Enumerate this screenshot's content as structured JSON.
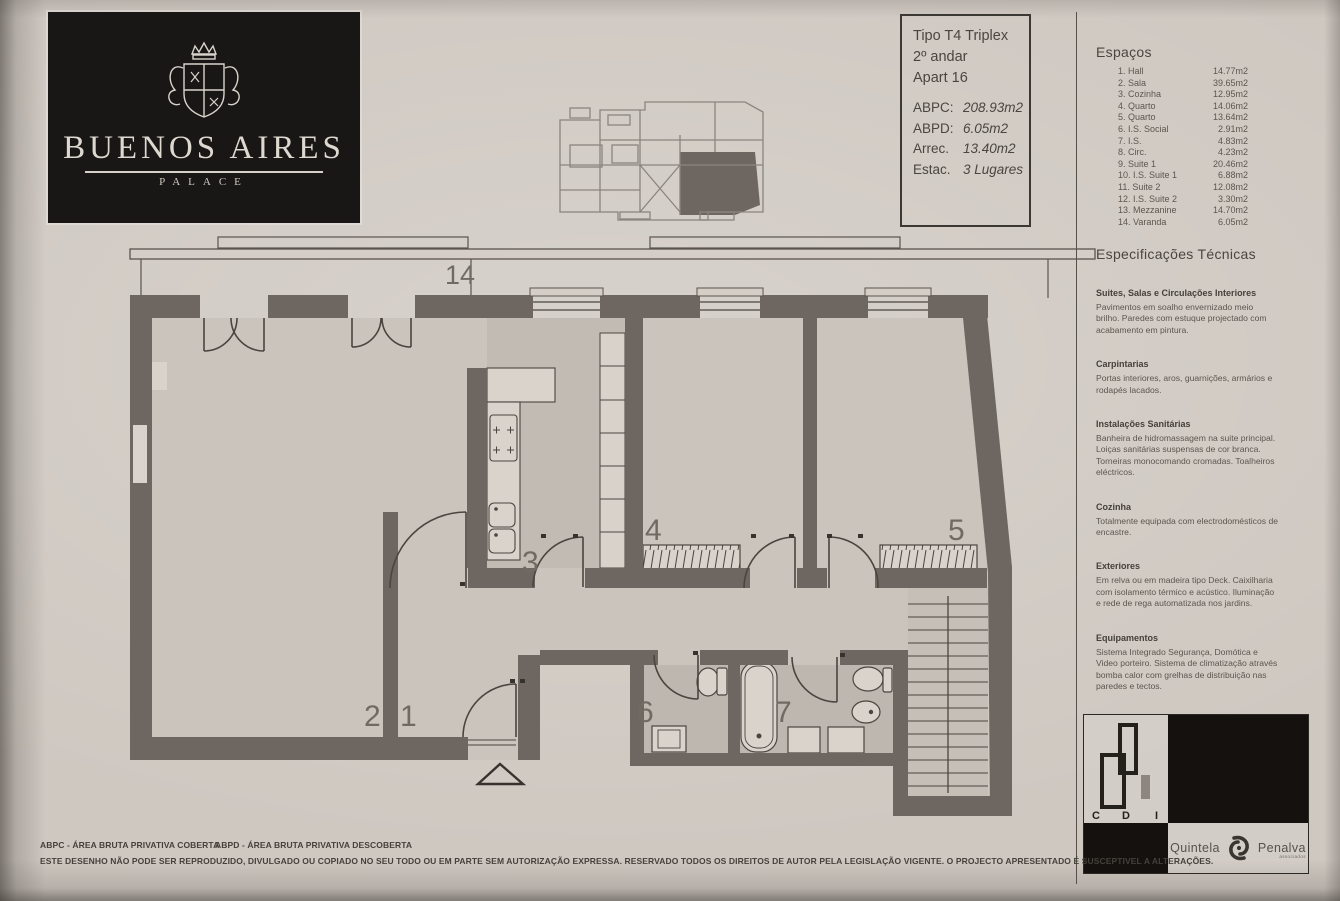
{
  "logo": {
    "brand": "Buenos Aires",
    "subtitle": "PALACE"
  },
  "info_box": {
    "type": "Tipo T4 Triplex",
    "floor": "2º andar",
    "apartment": "Apart 16",
    "metrics": [
      {
        "label": "ABPC:",
        "value": "208.93m2"
      },
      {
        "label": "ABPD:",
        "value": "6.05m2"
      },
      {
        "label": "Arrec.",
        "value": "13.40m2"
      },
      {
        "label": "Estac.",
        "value": "3 Lugares"
      }
    ]
  },
  "spaces": {
    "title": "Espaços",
    "items": [
      {
        "name": "1. Hall",
        "area": "14.77m2"
      },
      {
        "name": "2. Sala",
        "area": "39.65m2"
      },
      {
        "name": "3. Cozinha",
        "area": "12.95m2"
      },
      {
        "name": "4. Quarto",
        "area": "14.06m2"
      },
      {
        "name": "5. Quarto",
        "area": "13.64m2"
      },
      {
        "name": "6. I.S. Social",
        "area": "2.91m2"
      },
      {
        "name": "7. I.S.",
        "area": "4.83m2"
      },
      {
        "name": "8. Circ.",
        "area": "4.23m2"
      },
      {
        "name": "9. Suite 1",
        "area": "20.46m2"
      },
      {
        "name": "10. I.S. Suite 1",
        "area": "6.88m2"
      },
      {
        "name": "11. Suite 2",
        "area": "12.08m2"
      },
      {
        "name": "12. I.S. Suite 2",
        "area": "3.30m2"
      },
      {
        "name": "13. Mezzanine",
        "area": "14.70m2"
      },
      {
        "name": "14. Varanda",
        "area": "6.05m2"
      }
    ]
  },
  "specs": {
    "title": "Especificações Técnicas",
    "sections": [
      {
        "heading": "Suites, Salas e Circulações Interiores",
        "body": "Pavimentos em soalho envernizado meio brilho. Paredes com estuque projectado com acabamento em pintura."
      },
      {
        "heading": "Carpintarias",
        "body": "Portas interiores, aros, guarnições, armários e rodapés lacados."
      },
      {
        "heading": "Instalações Sanitárias",
        "body": "Banheira de hidromassagem na suite principal. Loiças sanitárias suspensas de cor branca. Torneiras monocomando cromadas. Toalheiros eléctricos."
      },
      {
        "heading": "Cozinha",
        "body": "Totalmente equipada com electrodomésticos de encastre."
      },
      {
        "heading": "Exteriores",
        "body": "Em relva ou em madeira tipo Deck. Caixilharia com isolamento térmico e acústico. Iluminação e rede de rega automatizada nos jardins."
      },
      {
        "heading": "Equipamentos",
        "body": "Sistema Integrado Segurança, Domótica e Video porteiro. Sistema de climatização através bomba calor com grelhas de distribuição nas paredes e tectos."
      }
    ]
  },
  "plan": {
    "labels": [
      {
        "text": "14"
      },
      {
        "text": "2"
      },
      {
        "text": "1"
      },
      {
        "text": "3"
      },
      {
        "text": "4"
      },
      {
        "text": "5"
      },
      {
        "text": "6"
      },
      {
        "text": "7"
      }
    ]
  },
  "footer": {
    "abpc_def": "ABPC - ÁREA BRUTA PRIVATIVA COBERTA",
    "abpd_def": "ABPD - ÁREA BRUTA PRIVATIVA DESCOBERTA",
    "notice": "ESTE DESENHO NÃO PODE SER REPRODUZIDO, DIVULGADO OU COPIADO NO SEU TODO OU EM PARTE SEM AUTORIZAÇÃO EXPRESSA. RESERVADO TODOS OS DIREITOS DE AUTOR PELA LEGISLAÇÃO VIGENTE. O PROJECTO APRESENTADO É SUSCEPTIVEL A ALTERAÇÕES.",
    "colors": {
      "wall": "#6e6761",
      "paper": "#cfc8c1"
    }
  },
  "logos": {
    "cdi": {
      "c": "C",
      "d": "D",
      "i": "I"
    },
    "quintela_penalva": {
      "left": "Quintela",
      "right": "Penalva",
      "sub": "associados"
    }
  }
}
